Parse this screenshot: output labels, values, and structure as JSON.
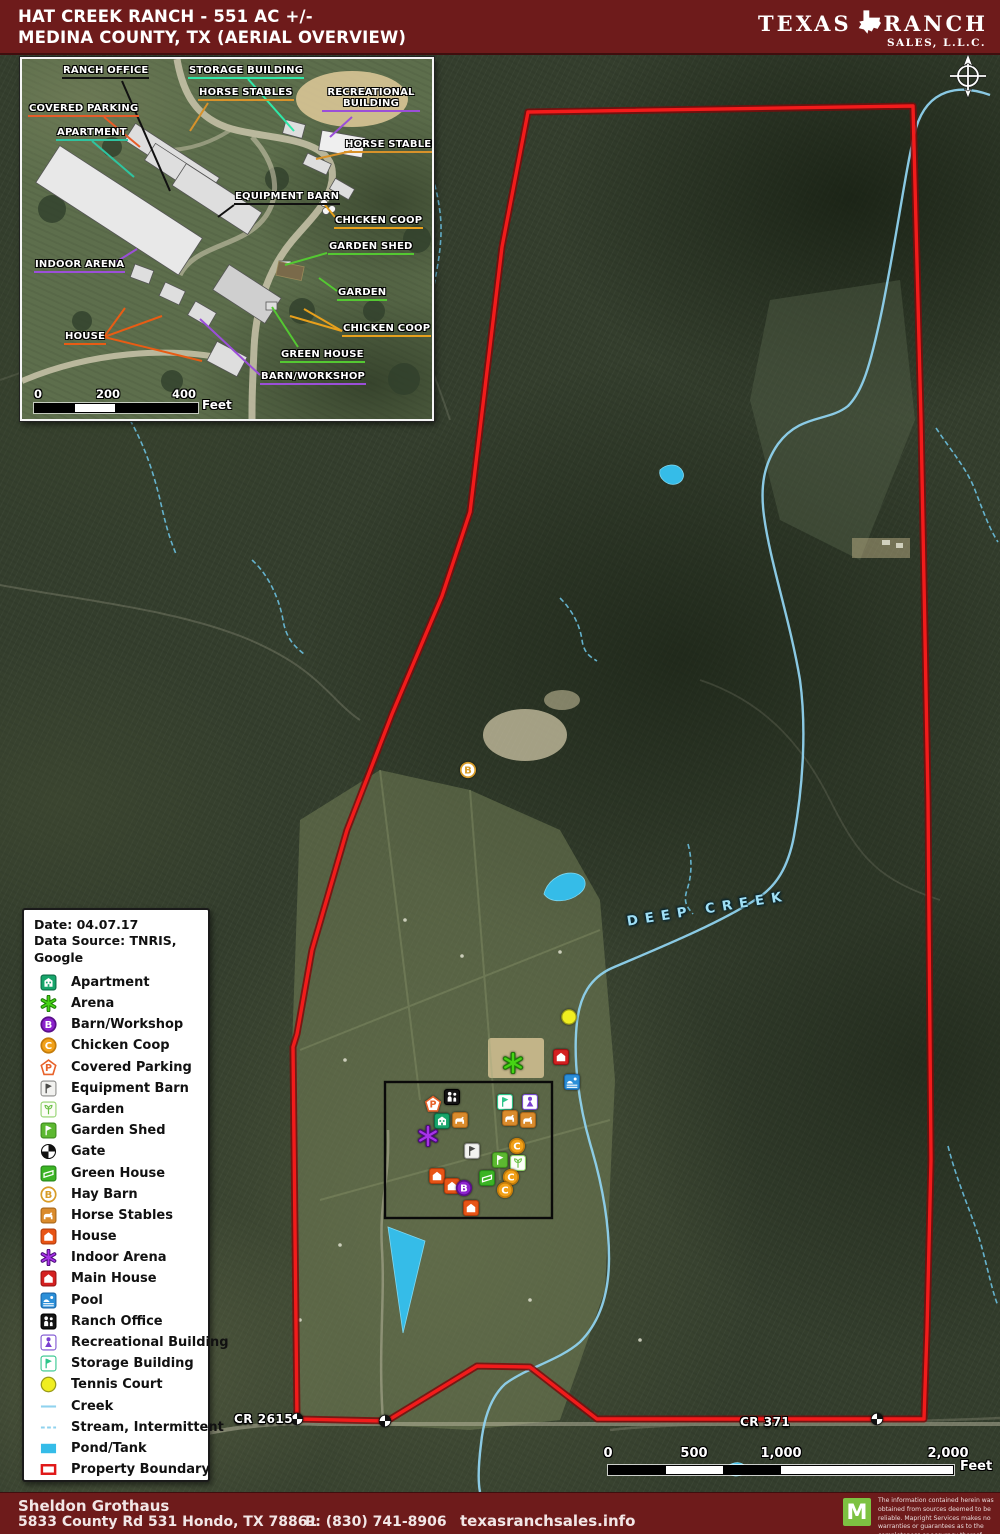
{
  "header": {
    "title1": "HAT CREEK RANCH - 551 AC +/-",
    "title2": "MEDINA COUNTY, TX (AERIAL OVERVIEW)",
    "logo_left": "TEXAS",
    "logo_right": "RANCH",
    "logo_sub": "SALES, L.L.C."
  },
  "legend": {
    "date": "Date: 04.07.17",
    "source": "Data Source: TNRIS, Google",
    "items": [
      {
        "icon": "apartment",
        "label": "Apartment"
      },
      {
        "icon": "arena",
        "label": "Arena"
      },
      {
        "icon": "barn_workshop",
        "label": "Barn/Workshop"
      },
      {
        "icon": "chicken_coop",
        "label": "Chicken Coop"
      },
      {
        "icon": "covered_parking",
        "label": "Covered Parking"
      },
      {
        "icon": "equipment_barn",
        "label": "Equipment Barn"
      },
      {
        "icon": "garden",
        "label": "Garden"
      },
      {
        "icon": "garden_shed",
        "label": "Garden Shed"
      },
      {
        "icon": "gate",
        "label": "Gate"
      },
      {
        "icon": "green_house",
        "label": "Green House"
      },
      {
        "icon": "hay_barn",
        "label": "Hay Barn"
      },
      {
        "icon": "horse_stables",
        "label": "Horse Stables"
      },
      {
        "icon": "house",
        "label": "House"
      },
      {
        "icon": "indoor_arena",
        "label": "Indoor Arena"
      },
      {
        "icon": "main_house",
        "label": "Main House"
      },
      {
        "icon": "pool",
        "label": "Pool"
      },
      {
        "icon": "ranch_office",
        "label": "Ranch Office"
      },
      {
        "icon": "recreational_building",
        "label": "Recreational Building"
      },
      {
        "icon": "storage_building",
        "label": "Storage Building"
      },
      {
        "icon": "tennis_court",
        "label": "Tennis Court"
      },
      {
        "icon": "creek",
        "label": "Creek"
      },
      {
        "icon": "stream",
        "label": "Stream, Intermittent"
      },
      {
        "icon": "pond",
        "label": "Pond/Tank"
      },
      {
        "icon": "boundary",
        "label": "Property Boundary"
      }
    ]
  },
  "inset": {
    "scale": {
      "ticks": [
        "0",
        "200",
        "400"
      ],
      "unit": "Feet"
    },
    "labels": [
      {
        "id": "ranch-office",
        "text": "RANCH OFFICE",
        "color": "#111111",
        "x": 40,
        "y": 6,
        "leaders": [
          [
            [
              100,
              22
            ],
            [
              148,
              132
            ]
          ]
        ]
      },
      {
        "id": "storage-building",
        "text": "STORAGE BUILDING",
        "color": "#2ee8a8",
        "x": 166,
        "y": 6,
        "leaders": [
          [
            [
              226,
              20
            ],
            [
              272,
              72
            ]
          ]
        ]
      },
      {
        "id": "horse-stables-top",
        "text": "HORSE STABLES",
        "color": "#d8922a",
        "x": 176,
        "y": 28,
        "leaders": [
          [
            [
              186,
              44
            ],
            [
              168,
              72
            ]
          ]
        ]
      },
      {
        "id": "recreational-building",
        "text": "RECREATIONAL BUILDING",
        "color": "#9b4fd8",
        "x": 300,
        "y": 28,
        "wide": true,
        "leaders": [
          [
            [
              330,
              58
            ],
            [
              308,
              78
            ]
          ]
        ]
      },
      {
        "id": "covered-parking",
        "text": "COVERED PARKING",
        "color": "#e85c28",
        "x": 6,
        "y": 44,
        "leaders": [
          [
            [
              82,
              58
            ],
            [
              118,
              88
            ]
          ]
        ]
      },
      {
        "id": "apartment",
        "text": "APARTMENT",
        "color": "#2ec4a0",
        "x": 34,
        "y": 68,
        "leaders": [
          [
            [
              70,
              82
            ],
            [
              112,
              118
            ]
          ]
        ]
      },
      {
        "id": "horse-stables-right",
        "text": "HORSE STABLES",
        "color": "#d8922a",
        "x": 322,
        "y": 80,
        "leaders": [
          [
            [
              330,
              92
            ],
            [
              294,
              100
            ]
          ]
        ]
      },
      {
        "id": "equipment-barn",
        "text": "EQUIPMENT BARN",
        "color": "#111111",
        "x": 212,
        "y": 132,
        "leaders": [
          [
            [
              212,
              146
            ],
            [
              196,
              158
            ]
          ]
        ]
      },
      {
        "id": "chicken-coop-top",
        "text": "CHICKEN COOP",
        "color": "#e8a01c",
        "x": 312,
        "y": 156,
        "leaders": [
          [
            [
              313,
              158
            ],
            [
              303,
              146
            ]
          ]
        ]
      },
      {
        "id": "garden-shed",
        "text": "GARDEN SHED",
        "color": "#54c832",
        "x": 306,
        "y": 182,
        "leaders": [
          [
            [
              305,
              194
            ],
            [
              263,
              206
            ]
          ]
        ]
      },
      {
        "id": "indoor-arena",
        "text": "INDOOR ARENA",
        "color": "#9b4fd8",
        "x": 12,
        "y": 200,
        "leaders": [
          [
            [
              86,
              208
            ],
            [
              115,
              190
            ]
          ]
        ]
      },
      {
        "id": "garden",
        "text": "GARDEN",
        "color": "#54c832",
        "x": 315,
        "y": 228,
        "leaders": [
          [
            [
              315,
              232
            ],
            [
              297,
              219
            ]
          ]
        ]
      },
      {
        "id": "chicken-coop-lower",
        "text": "CHICKEN COOP",
        "color": "#e8a01c",
        "x": 320,
        "y": 264,
        "leaders": [
          [
            [
              320,
              272
            ],
            [
              282,
              250
            ]
          ],
          [
            [
              320,
              272
            ],
            [
              268,
              257
            ]
          ]
        ]
      },
      {
        "id": "house",
        "text": "HOUSE",
        "color": "#e85c14",
        "x": 42,
        "y": 272,
        "leaders": [
          [
            [
              82,
              278
            ],
            [
              103,
              249
            ]
          ],
          [
            [
              82,
              278
            ],
            [
              140,
              257
            ]
          ],
          [
            [
              82,
              278
            ],
            [
              180,
              302
            ]
          ]
        ]
      },
      {
        "id": "green-house",
        "text": "GREEN HOUSE",
        "color": "#54c832",
        "x": 258,
        "y": 290,
        "leaders": [
          [
            [
              276,
              288
            ],
            [
              250,
              248
            ]
          ]
        ]
      },
      {
        "id": "barn-workshop",
        "text": "BARN/WORKSHOP",
        "color": "#9b4fd8",
        "x": 238,
        "y": 312,
        "leaders": [
          [
            [
              238,
              316
            ],
            [
              178,
              260
            ]
          ]
        ]
      }
    ]
  },
  "map": {
    "road1": "CR 2615",
    "road2": "CR 371",
    "creek_label": "DEEP CREEK",
    "scale": {
      "ticks": [
        "0",
        "500",
        "1,000",
        "2,000"
      ],
      "unit": "Feet"
    },
    "icons": [
      {
        "t": "hay_barn",
        "x": 468,
        "y": 770
      },
      {
        "t": "tennis_court",
        "x": 569,
        "y": 1017
      },
      {
        "t": "arena",
        "x": 513,
        "y": 1063
      },
      {
        "t": "main_house",
        "x": 561,
        "y": 1057
      },
      {
        "t": "pool",
        "x": 572,
        "y": 1082
      },
      {
        "t": "covered_parking",
        "x": 433,
        "y": 1104
      },
      {
        "t": "ranch_office",
        "x": 452,
        "y": 1097
      },
      {
        "t": "storage_building",
        "x": 505,
        "y": 1102
      },
      {
        "t": "recreational_building",
        "x": 530,
        "y": 1102
      },
      {
        "t": "apartment",
        "x": 442,
        "y": 1121
      },
      {
        "t": "horse_stables",
        "x": 460,
        "y": 1120
      },
      {
        "t": "horse_stables",
        "x": 510,
        "y": 1118
      },
      {
        "t": "horse_stables",
        "x": 528,
        "y": 1120
      },
      {
        "t": "indoor_arena",
        "x": 428,
        "y": 1136
      },
      {
        "t": "equipment_barn",
        "x": 472,
        "y": 1151
      },
      {
        "t": "chicken_coop",
        "x": 517,
        "y": 1146
      },
      {
        "t": "garden_shed",
        "x": 500,
        "y": 1160
      },
      {
        "t": "garden",
        "x": 518,
        "y": 1163
      },
      {
        "t": "green_house",
        "x": 487,
        "y": 1178
      },
      {
        "t": "chicken_coop",
        "x": 511,
        "y": 1177
      },
      {
        "t": "house",
        "x": 437,
        "y": 1176
      },
      {
        "t": "house",
        "x": 452,
        "y": 1186
      },
      {
        "t": "barn_workshop",
        "x": 464,
        "y": 1188
      },
      {
        "t": "chicken_coop",
        "x": 505,
        "y": 1190
      },
      {
        "t": "house",
        "x": 471,
        "y": 1208
      },
      {
        "t": "gate",
        "x": 297,
        "y": 1419
      },
      {
        "t": "gate",
        "x": 385,
        "y": 1421
      },
      {
        "t": "gate",
        "x": 877,
        "y": 1419
      }
    ],
    "vectors": {
      "boundary": "528,112 913,106 921,420 928,800 931,1160 927,1330 924,1419 597,1419 530,1367 477,1366 387,1421 297,1419 293,1047 297,1034 312,950 347,830 392,714 442,596 470,512 502,247",
      "creek": "M990 95 C960 84 928 88 916 128 C906 165 898 230 882 310 C870 368 862 392 848 406 C828 422 800 414 778 444 C764 464 760 486 764 516 C770 562 790 620 800 680 C806 724 804 780 794 836 C788 868 776 886 758 898 C722 922 664 946 612 968 C590 978 580 996 577 1022 C573 1058 578 1104 592 1150 C603 1188 609 1226 609 1258 C609 1294 600 1322 580 1342 C560 1360 526 1368 505 1384 C492 1396 484 1416 481 1444 C478 1468 478 1482 480 1492",
      "streams": [
        "M402 86c10 44 32 78 38 126s-16 92-12 136 2 50 0 74",
        "M252 560c18 16 28 42 31 60s11 26 21 34",
        "M560 598c13 13 20 28 22 42s9 17 15 21",
        "M688 844c5 18 3 34-1 46s0 17 6 24",
        "M936 428c16 24 31 41 39 62s15 40 23 52",
        "M948 1146c10 40 26 72 34 102s10 42 16 58",
        "M130 420c16 28 25 58 31 84s9 35 15 50"
      ],
      "ponds": [
        "M660 470c6-6 16-7 21-1s2 13-5 15c-9 2-18-6-16-14z",
        "M544 894c4-16 22-24 33-20s10 14 2 20c-10 8-28 10-35 0z",
        "M388 1227l37 14-22 92z",
        "M728 1466c7-5 15-4 17 1s-3 9-9 9-11-6-8-10z"
      ]
    }
  },
  "footer": {
    "name": "Sheldon Grothaus",
    "address": "5833 County Rd 531 Hondo, TX 78861",
    "phone": "P: (830) 741-8906",
    "website": "texasranchsales.info",
    "logo_letter": "M",
    "disclaimer": "The information contained herein was obtained from sources deemed to be reliable. Mapright Services makes no warranties or guarantees as to the completeness or accuracy thereof.\n844.932.6277   www.mapright.com"
  }
}
